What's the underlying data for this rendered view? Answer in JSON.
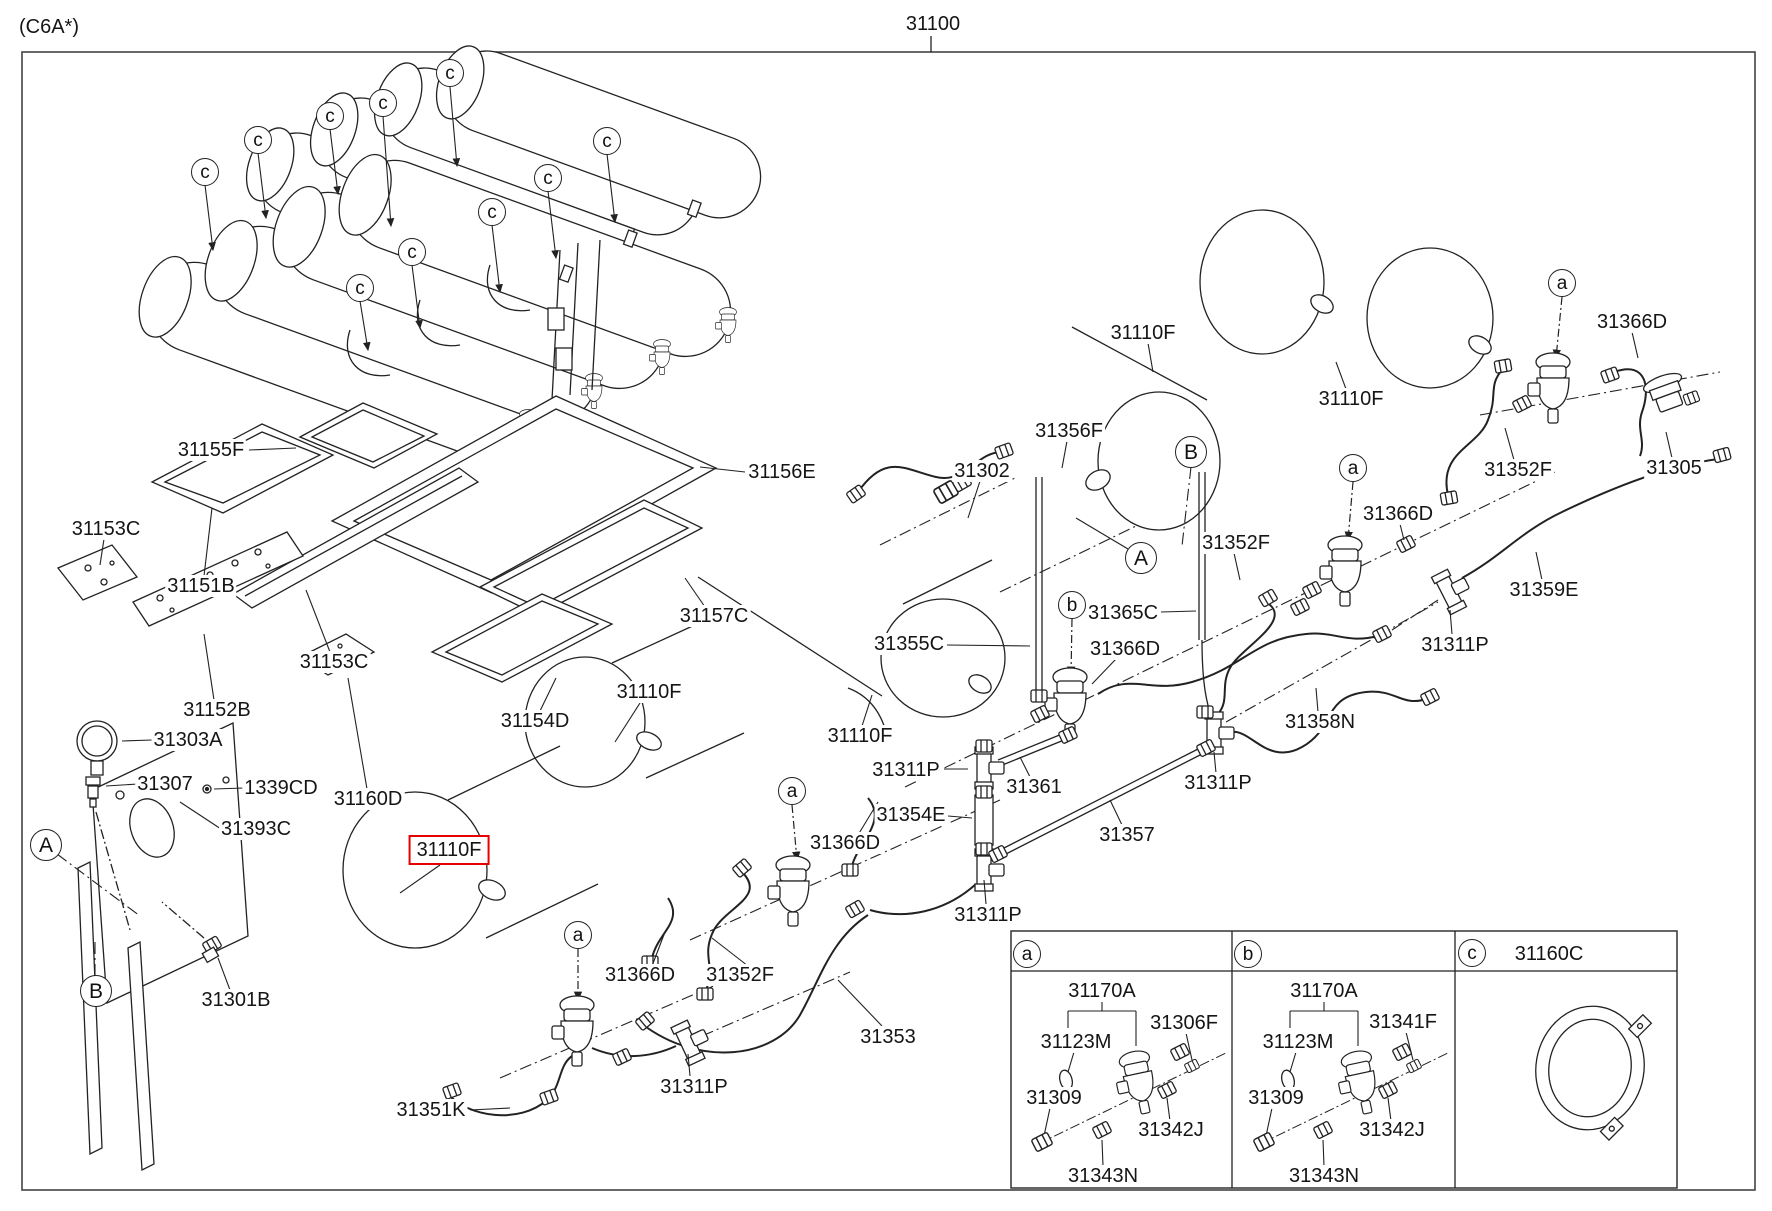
{
  "meta": {
    "variant_code": "(C6A*)",
    "assembly_number": "31100",
    "highlight_color": "#e60000",
    "line_color": "#222222"
  },
  "part_labels": [
    {
      "text": "(C6A*)",
      "x": 49,
      "y": 27
    },
    {
      "text": "31100",
      "x": 933,
      "y": 24
    },
    {
      "text": "31155F",
      "x": 211,
      "y": 450
    },
    {
      "text": "31153C",
      "x": 106,
      "y": 529
    },
    {
      "text": "31151B",
      "x": 201,
      "y": 586
    },
    {
      "text": "31153C",
      "x": 334,
      "y": 662
    },
    {
      "text": "31152B",
      "x": 217,
      "y": 710
    },
    {
      "text": "31303A",
      "x": 188,
      "y": 740
    },
    {
      "text": "31307",
      "x": 165,
      "y": 784
    },
    {
      "text": "1339CD",
      "x": 281,
      "y": 788
    },
    {
      "text": "31160D",
      "x": 368,
      "y": 799
    },
    {
      "text": "31393C",
      "x": 256,
      "y": 829
    },
    {
      "text": "31301B",
      "x": 236,
      "y": 1000
    },
    {
      "text": "31110F",
      "x": 449,
      "y": 850,
      "boxed": true
    },
    {
      "text": "31351K",
      "x": 431,
      "y": 1110
    },
    {
      "text": "31110F",
      "x": 649,
      "y": 692
    },
    {
      "text": "31154D",
      "x": 535,
      "y": 721
    },
    {
      "text": "31156E",
      "x": 782,
      "y": 472
    },
    {
      "text": "31157C",
      "x": 714,
      "y": 616
    },
    {
      "text": "31110F",
      "x": 860,
      "y": 736
    },
    {
      "text": "31355C",
      "x": 909,
      "y": 644
    },
    {
      "text": "31302",
      "x": 982,
      "y": 471
    },
    {
      "text": "31356F",
      "x": 1069,
      "y": 431
    },
    {
      "text": "31110F",
      "x": 1143,
      "y": 333
    },
    {
      "text": "31365C",
      "x": 1123,
      "y": 613
    },
    {
      "text": "31366D",
      "x": 1125,
      "y": 649
    },
    {
      "text": "31366D",
      "x": 845,
      "y": 843
    },
    {
      "text": "31366D",
      "x": 640,
      "y": 975
    },
    {
      "text": "31352F",
      "x": 740,
      "y": 975
    },
    {
      "text": "31311P",
      "x": 694,
      "y": 1087
    },
    {
      "text": "31353",
      "x": 888,
      "y": 1037
    },
    {
      "text": "31311P",
      "x": 906,
      "y": 770
    },
    {
      "text": "31361",
      "x": 1034,
      "y": 787
    },
    {
      "text": "31354E",
      "x": 911,
      "y": 815
    },
    {
      "text": "31357",
      "x": 1127,
      "y": 835
    },
    {
      "text": "31311P",
      "x": 1218,
      "y": 783
    },
    {
      "text": "31311P",
      "x": 988,
      "y": 915
    },
    {
      "text": "31358N",
      "x": 1320,
      "y": 722
    },
    {
      "text": "31311P",
      "x": 1455,
      "y": 645
    },
    {
      "text": "31359E",
      "x": 1544,
      "y": 590
    },
    {
      "text": "31352F",
      "x": 1236,
      "y": 543
    },
    {
      "text": "31366D",
      "x": 1398,
      "y": 514
    },
    {
      "text": "31110F",
      "x": 1351,
      "y": 399
    },
    {
      "text": "31352F",
      "x": 1518,
      "y": 470
    },
    {
      "text": "31366D",
      "x": 1632,
      "y": 322
    },
    {
      "text": "31305",
      "x": 1674,
      "y": 468
    },
    {
      "text": "31160C",
      "x": 1549,
      "y": 954
    },
    {
      "text": "31170A",
      "x": 1102,
      "y": 991
    },
    {
      "text": "31123M",
      "x": 1076,
      "y": 1042
    },
    {
      "text": "31306F",
      "x": 1184,
      "y": 1023
    },
    {
      "text": "31309",
      "x": 1054,
      "y": 1098
    },
    {
      "text": "31342J",
      "x": 1171,
      "y": 1130
    },
    {
      "text": "31343N",
      "x": 1103,
      "y": 1176
    },
    {
      "text": "31170A",
      "x": 1324,
      "y": 991
    },
    {
      "text": "31123M",
      "x": 1298,
      "y": 1042
    },
    {
      "text": "31341F",
      "x": 1403,
      "y": 1022
    },
    {
      "text": "31309",
      "x": 1276,
      "y": 1098
    },
    {
      "text": "31342J",
      "x": 1392,
      "y": 1130
    },
    {
      "text": "31343N",
      "x": 1324,
      "y": 1176
    }
  ],
  "callouts": [
    {
      "letter": "c",
      "x": 205,
      "y": 172,
      "size": "small"
    },
    {
      "letter": "c",
      "x": 258,
      "y": 140,
      "size": "small"
    },
    {
      "letter": "c",
      "x": 330,
      "y": 116,
      "size": "small"
    },
    {
      "letter": "c",
      "x": 383,
      "y": 103,
      "size": "small"
    },
    {
      "letter": "c",
      "x": 450,
      "y": 73,
      "size": "small"
    },
    {
      "letter": "c",
      "x": 360,
      "y": 288,
      "size": "small"
    },
    {
      "letter": "c",
      "x": 412,
      "y": 252,
      "size": "small"
    },
    {
      "letter": "c",
      "x": 492,
      "y": 212,
      "size": "small"
    },
    {
      "letter": "c",
      "x": 548,
      "y": 178,
      "size": "small"
    },
    {
      "letter": "c",
      "x": 607,
      "y": 141,
      "size": "small"
    },
    {
      "letter": "A",
      "x": 46,
      "y": 845,
      "size": "big"
    },
    {
      "letter": "B",
      "x": 96,
      "y": 991,
      "size": "big"
    },
    {
      "letter": "B",
      "x": 1191,
      "y": 452,
      "size": "big"
    },
    {
      "letter": "A",
      "x": 1141,
      "y": 558,
      "size": "big"
    },
    {
      "letter": "a",
      "x": 578,
      "y": 935,
      "size": "small"
    },
    {
      "letter": "a",
      "x": 792,
      "y": 791,
      "size": "small"
    },
    {
      "letter": "b",
      "x": 1072,
      "y": 605,
      "size": "small"
    },
    {
      "letter": "a",
      "x": 1353,
      "y": 468,
      "size": "small"
    },
    {
      "letter": "a",
      "x": 1562,
      "y": 283,
      "size": "small"
    },
    {
      "letter": "a",
      "x": 1027,
      "y": 954,
      "size": "small"
    },
    {
      "letter": "b",
      "x": 1248,
      "y": 954,
      "size": "small"
    },
    {
      "letter": "c",
      "x": 1472,
      "y": 953,
      "size": "small"
    }
  ]
}
